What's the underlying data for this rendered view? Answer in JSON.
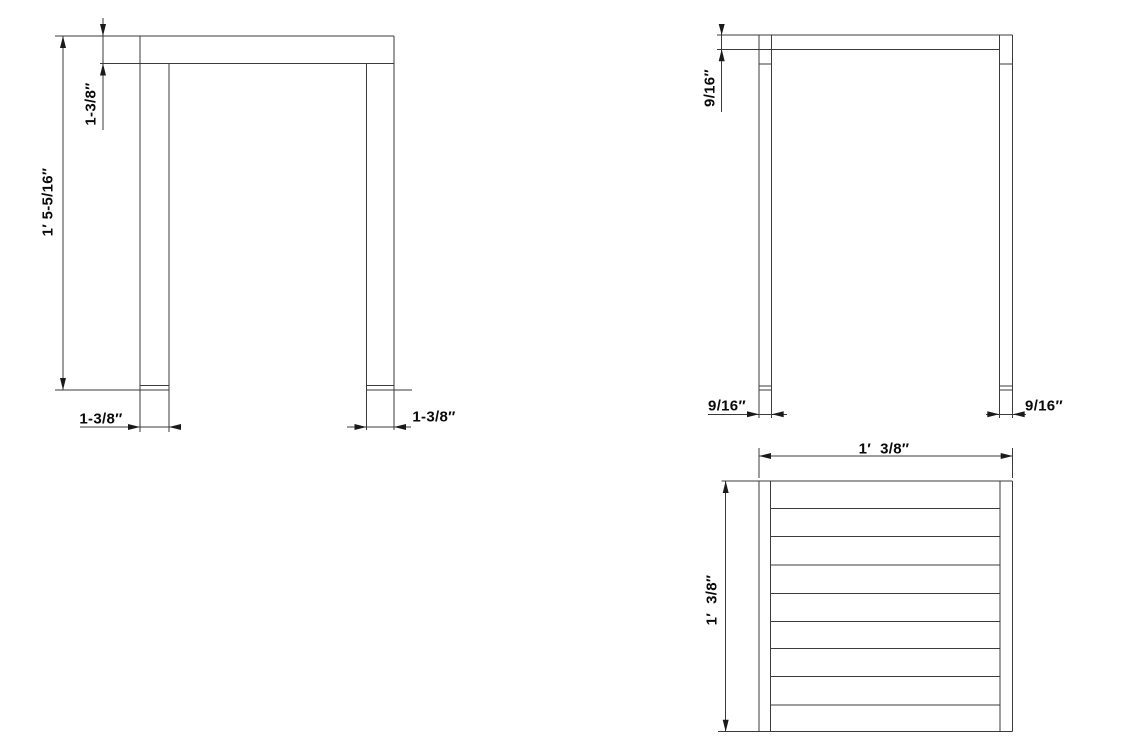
{
  "page": {
    "background_color": "#ffffff",
    "line_color": "#3b3b3b",
    "text_color": "#0a0a0a"
  },
  "drawing": {
    "kind": "orthographic technical drawing of a slatted-top side table",
    "front_view": {
      "overall_height_label": "1′ 5-5/16″",
      "apron_height_label": "1-3/8″",
      "left_leg_width_label": "1-3/8″",
      "right_leg_width_label": "1-3/8″"
    },
    "side_view": {
      "top_thickness_label": "9/16″",
      "left_leg_width_label": "9/16″",
      "right_leg_width_label": "9/16″"
    },
    "top_view": {
      "overall_width_label": "1′  3/8″",
      "overall_depth_label": "1′  3/8″",
      "slat_count": 9
    }
  }
}
